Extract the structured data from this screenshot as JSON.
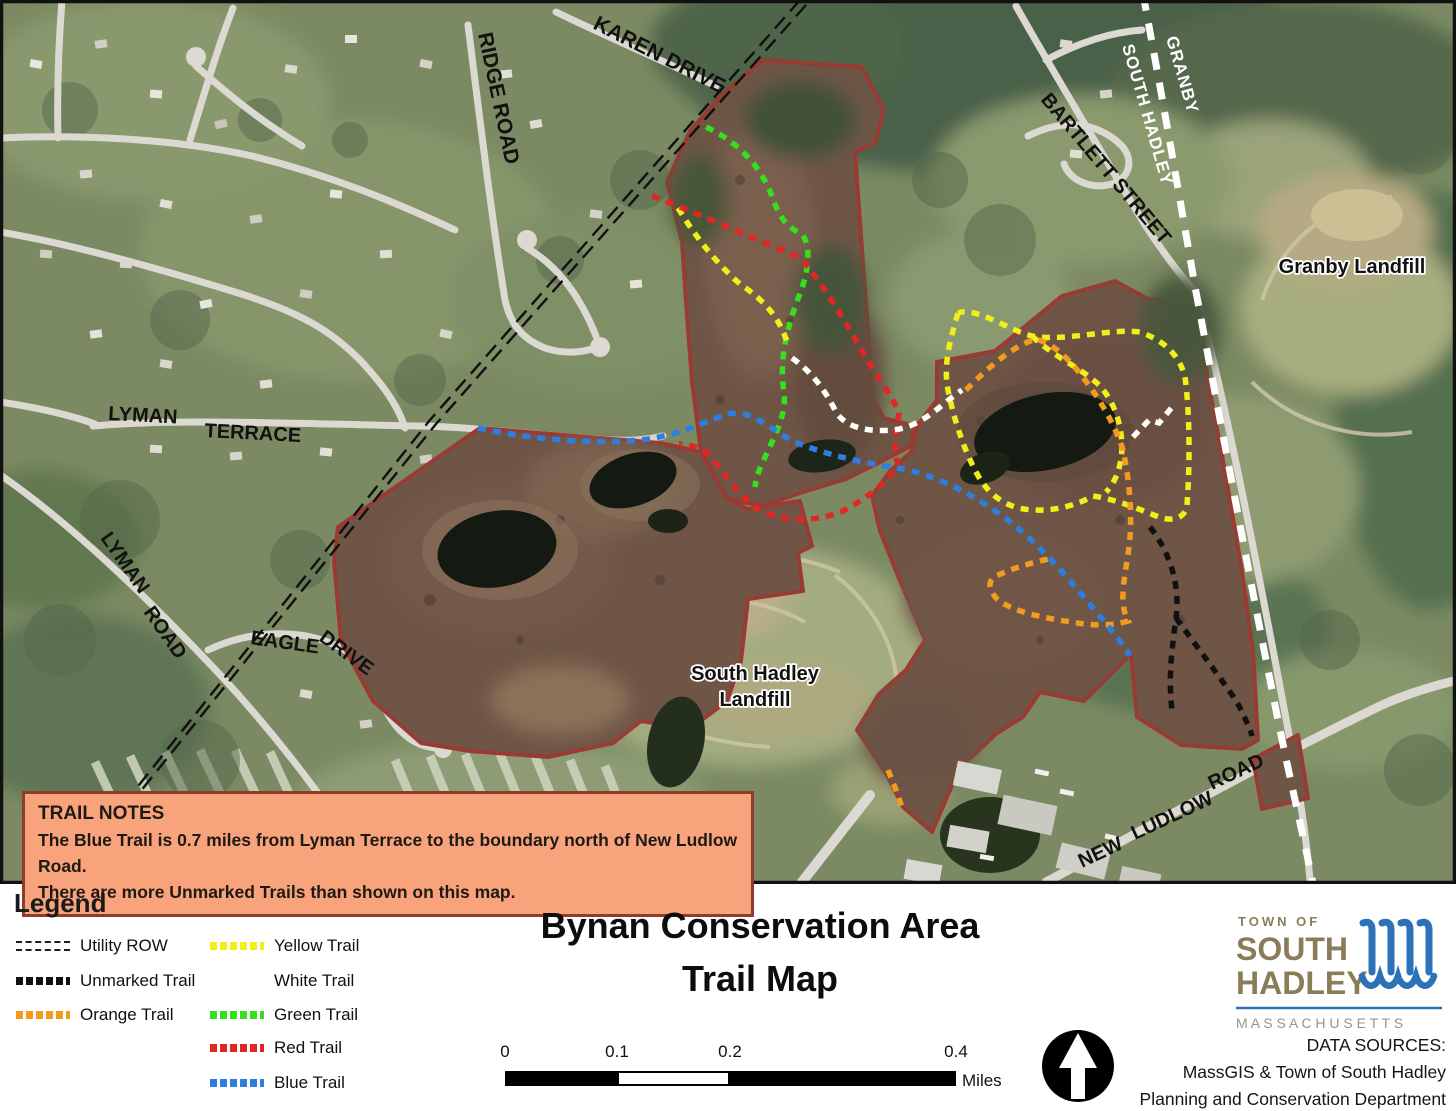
{
  "map": {
    "road_labels": {
      "karen_drive": "KAREN DRIVE",
      "ridge_road": "RIDGE ROAD",
      "bartlett_street": "BARTLETT STREET",
      "lyman": "LYMAN",
      "terrace": "TERRACE",
      "lyman2": "LYMAN",
      "road2": "ROAD",
      "eagle": "EAGLE",
      "drive": "DRIVE",
      "new": "NEW",
      "ludlow": "LUDLOW",
      "road3": "ROAD"
    },
    "boundary_labels": {
      "granby": "GRANBY",
      "south_hadley": "SOUTH HADLEY"
    },
    "place_labels": {
      "granby_landfill": "Granby Landfill",
      "sh_landfill_line1": "South Hadley",
      "sh_landfill_line2": "Landfill"
    },
    "trail_notes": {
      "heading": "TRAIL NOTES",
      "line1": "The Blue Trail is 0.7 miles from Lyman Terrace to the boundary north of New Ludlow Road.",
      "line2": "There are more Unmarked Trails than shown on this map.",
      "background_color": "#F9A37D"
    }
  },
  "legend": {
    "heading": "Legend",
    "items": [
      {
        "label": "Utility ROW",
        "color": "#1d1d1d",
        "style": "double-dash"
      },
      {
        "label": "Unmarked Trail",
        "color": "#111111",
        "style": "dots"
      },
      {
        "label": "Orange Trail",
        "color": "#F29C1F",
        "style": "dots"
      },
      {
        "label": "Yellow Trail",
        "color": "#F2EE1C",
        "style": "dots"
      },
      {
        "label": "White Trail",
        "color": "#FFFFFF",
        "style": "dots"
      },
      {
        "label": "Green Trail",
        "color": "#35E01F",
        "style": "dots"
      },
      {
        "label": "Red Trail",
        "color": "#E02723",
        "style": "dots"
      },
      {
        "label": "Blue Trail",
        "color": "#2E7EE0",
        "style": "dots"
      }
    ]
  },
  "title": {
    "line1": "Bynan Conservation Area",
    "line2": "Trail Map"
  },
  "scale_bar": {
    "ticks": [
      "0",
      "0.1",
      "0.2",
      "0.4"
    ],
    "unit": "Miles"
  },
  "north_arrow": {
    "name": "north-arrow"
  },
  "logo": {
    "town_of": "TOWN OF",
    "name_line1": "SOUTH",
    "name_line2": "HADLEY",
    "state": "M A S S A C H U S E T T S",
    "text_color": "#8a7c59",
    "water_color": "#2b72b8"
  },
  "data_sources": {
    "line1": "DATA SOURCES:",
    "line2": "MassGIS & Town of South Hadley",
    "line3": "Planning and Conservation Department"
  },
  "colors": {
    "boundary_red": "#993b33",
    "parcel_brown": "#6e5546",
    "town_boundary": "#ffffff",
    "road_gray": "#dbd9d1"
  }
}
